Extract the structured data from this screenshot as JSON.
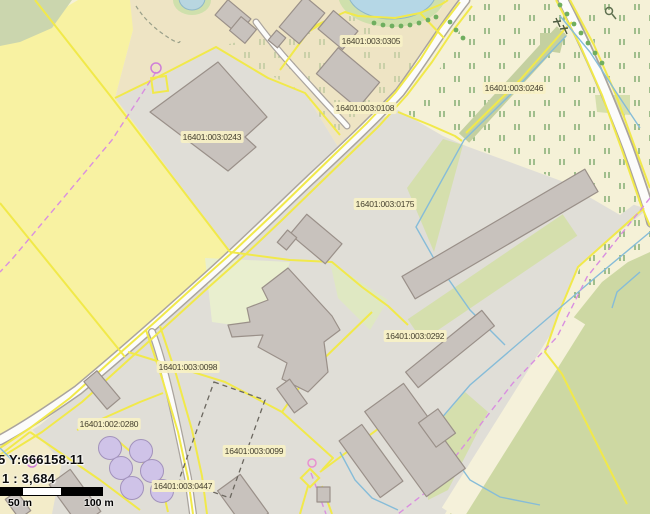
{
  "map": {
    "parcels": [
      {
        "id": "0305",
        "label": "16401:003:0305",
        "x": 371,
        "y": 41
      },
      {
        "id": "0108",
        "label": "16401:003:0108",
        "x": 365,
        "y": 108
      },
      {
        "id": "0246",
        "label": "16401:003:0246",
        "x": 514,
        "y": 88
      },
      {
        "id": "0243",
        "label": "16401:003:0243",
        "x": 212,
        "y": 137
      },
      {
        "id": "0175",
        "label": "16401:003:0175",
        "x": 385,
        "y": 204
      },
      {
        "id": "0292",
        "label": "16401:003:0292",
        "x": 415,
        "y": 336
      },
      {
        "id": "0098",
        "label": "16401:003:0098",
        "x": 188,
        "y": 367
      },
      {
        "id": "0280",
        "label": "16401:002:0280",
        "x": 109,
        "y": 424
      },
      {
        "id": "0099",
        "label": "16401:003:0099",
        "x": 254,
        "y": 451
      },
      {
        "id": "0447",
        "label": "16401:003:0447",
        "x": 183,
        "y": 486
      }
    ],
    "status_bar": {
      "coordinates": "5 Y:666158.11",
      "scale": "1 : 3,684",
      "scalebar": {
        "mid_label": "50 m",
        "end_label": "100 m"
      }
    },
    "colors": {
      "parcel_boundary": "#f1e94a",
      "field_yellow": "#f8f2a2",
      "pasture_cream": "#f5f1d7",
      "farmyard_tan": "#eee4c4",
      "farmyard_gray": "#e0ded7",
      "green_field": "#cdd8a3",
      "building_fill": "#c8c2bd",
      "building_outline": "#9a9089",
      "water": "#b5d7e6",
      "ditch_blue": "#86bcd8",
      "pipeline_violet": "#d98fe0",
      "tank_purple": "#cfc3e8",
      "road_fill": "#fcfcfa"
    }
  }
}
